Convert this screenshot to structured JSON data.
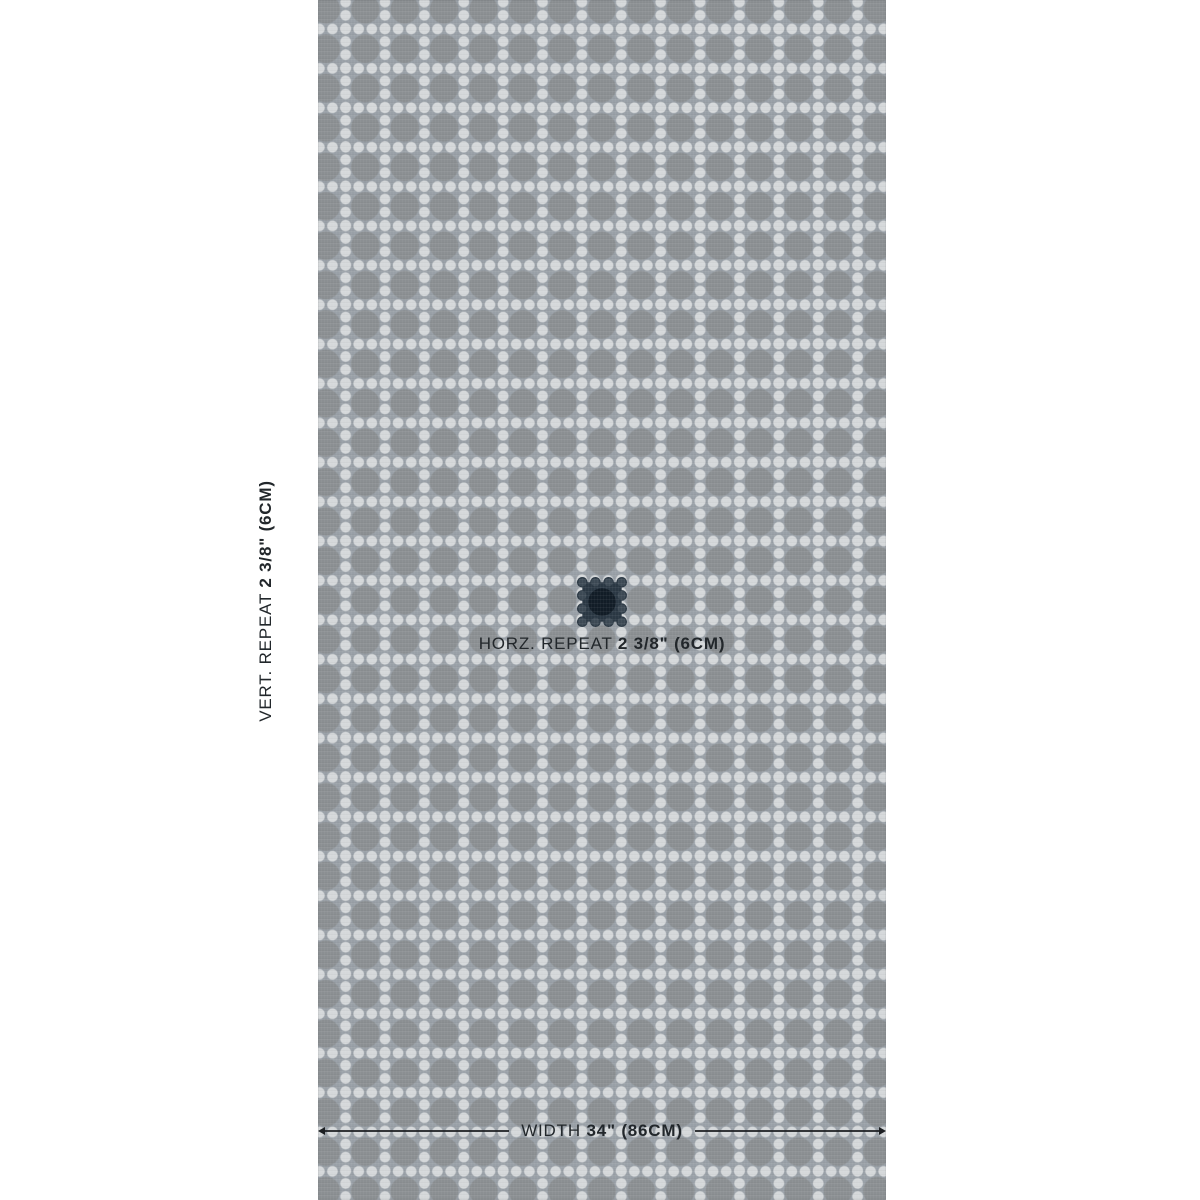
{
  "page": {
    "background": "#ffffff"
  },
  "labels": {
    "vertical_repeat": {
      "prefix": "VERT. REPEAT",
      "value": "2 3/8\" (6CM)"
    },
    "horizontal_repeat": {
      "prefix": "HORZ. REPEAT",
      "value": "2 3/8\" (6CM)"
    },
    "width": {
      "prefix": "WIDTH",
      "value": "34\" (86CM)"
    }
  },
  "swatch": {
    "pattern": "dot-lattice caning grid with circle motifs",
    "repeat_marker": "dark square highlighting one pattern repeat"
  },
  "colors": {
    "page_bg": "#ffffff",
    "swatch_bg": "#99a0a7",
    "motif_circle": "#8b8f92",
    "dot": "#d5d8da",
    "repeat_square": "#2b3844",
    "repeat_square_dot": "#3d4a55",
    "repeat_square_circle": "#121d27",
    "text": "#22272b",
    "measure_line": "#1c1f22"
  }
}
